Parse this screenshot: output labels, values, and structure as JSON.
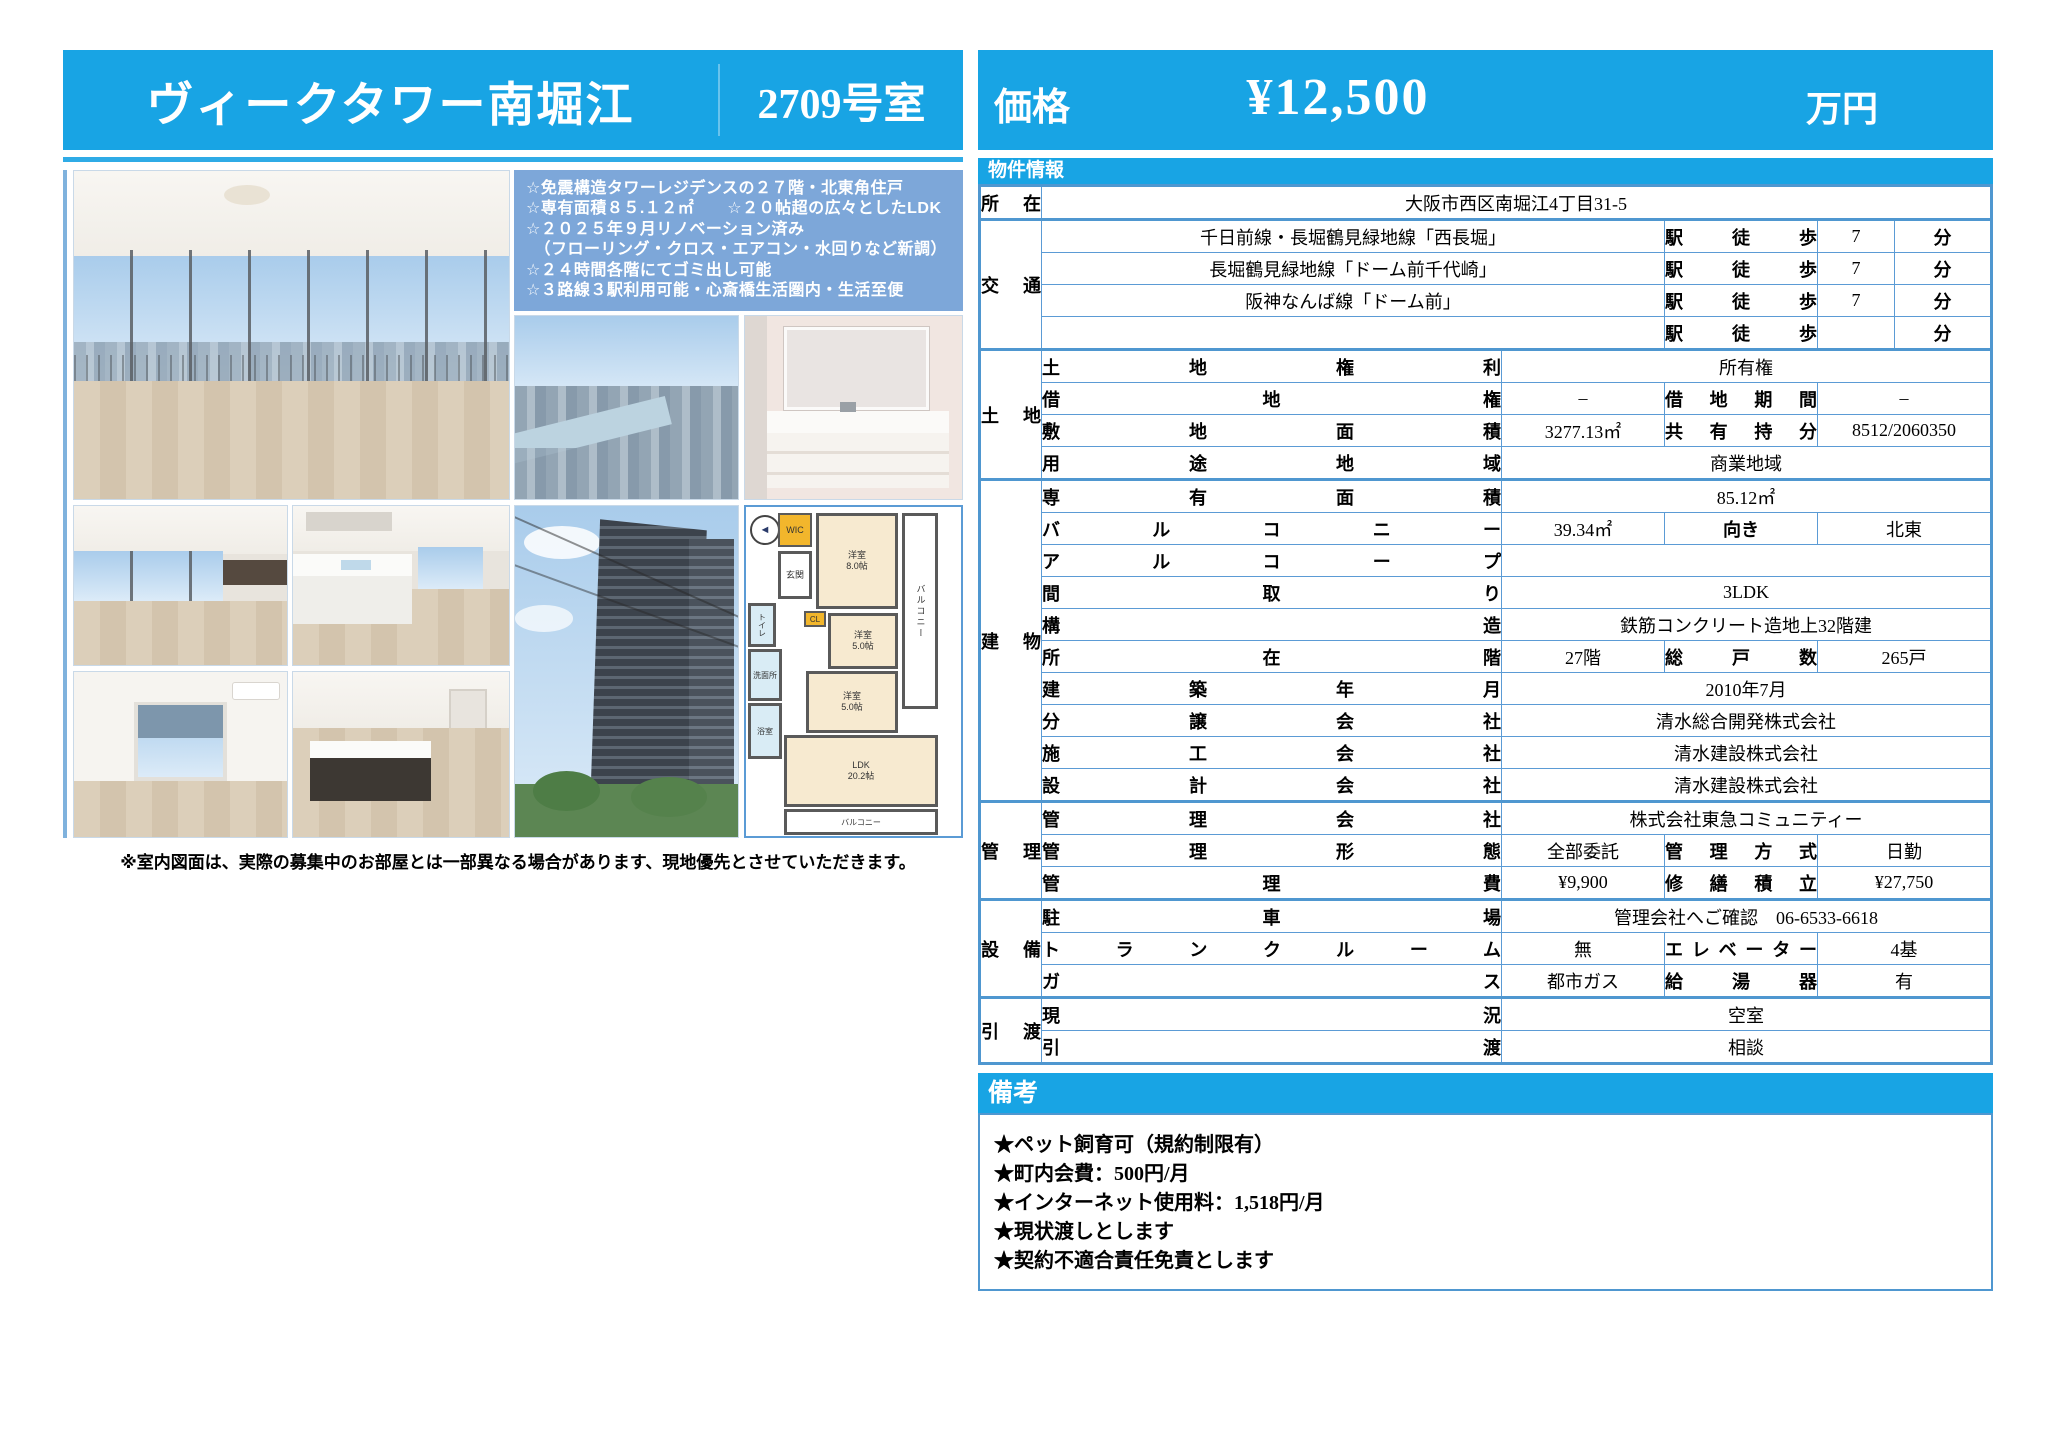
{
  "header": {
    "title": "ヴィークタワー南堀江",
    "room": "2709号室",
    "price_label": "価格",
    "price_value": "¥12,500",
    "price_unit": "万円"
  },
  "features": {
    "lines": [
      "☆免震構造タワーレジデンスの２７階・北東角住戸",
      "☆専有面積８５.１２㎡　　☆２０帖超の広々としたLDK",
      "☆２０２５年９月リノベーション済み",
      "　（フローリング・クロス・エアコン・水回りなど新調）",
      "☆２４時間各階にてゴミ出し可能",
      "☆３路線３駅利用可能・心斎橋生活圏内・生活至便"
    ]
  },
  "floorplan": {
    "wic": "WIC",
    "cl": "CL",
    "genkan": "玄関",
    "toilet": "トイレ",
    "wash": "洗面所",
    "bath": "浴室",
    "room_a": "洋室",
    "room_a_size": "8.0帖",
    "room_b": "洋室",
    "room_b_size": "5.0帖",
    "room_c": "洋室",
    "room_c_size": "5.0帖",
    "ldk": "LDK",
    "ldk_size": "20.2帖",
    "balcony": "バルコニー"
  },
  "disclaimer": "※室内図面は、実際の募集中のお部屋とは一部異なる場合があります、現地優先とさせていただきます。",
  "info": {
    "section_title": "物件情報",
    "shozai": {
      "label": "所 在",
      "value": "大阪市西区南堀江4丁目31-5"
    },
    "kotsu": {
      "label": "交 通",
      "rows": [
        {
          "line": "千日前線・長堀鶴見緑地線「西長堀」",
          "walk": "駅 徒 歩",
          "min": "7",
          "unit": "分"
        },
        {
          "line": "長堀鶴見緑地線「ドーム前千代崎」",
          "walk": "駅 徒 歩",
          "min": "7",
          "unit": "分"
        },
        {
          "line": "阪神なんば線「ドーム前」",
          "walk": "駅 徒 歩",
          "min": "7",
          "unit": "分"
        },
        {
          "line": "",
          "walk": "駅 徒 歩",
          "min": "",
          "unit": "分"
        }
      ]
    },
    "tochi": {
      "label": "土 地",
      "rows": [
        {
          "label": "土 地 権 利",
          "value": "所有権"
        },
        {
          "label": "借 地 権",
          "value": "–",
          "label2": "借 地 期 間",
          "value2": "–"
        },
        {
          "label": "敷 地 面 積",
          "value": "3277.13㎡",
          "label2": "共 有 持 分",
          "value2": "8512/2060350"
        },
        {
          "label": "用 途 地 域",
          "value": "商業地域"
        }
      ]
    },
    "tatemono": {
      "label": "建 物",
      "rows": [
        {
          "label": "専 有 面 積",
          "value": "85.12㎡"
        },
        {
          "label": "バ ル コ ニ ー",
          "value": "39.34㎡",
          "label2": "向き",
          "value2": "北東"
        },
        {
          "label": "ア ル コ ー プ",
          "value": ""
        },
        {
          "label": "間 取 り",
          "value": "3LDK"
        },
        {
          "label": "構 造",
          "value": "鉄筋コンクリート造地上32階建"
        },
        {
          "label": "所 在 階",
          "value": "27階",
          "label2": "総 戸 数",
          "value2": "265戸"
        },
        {
          "label": "建 築 年 月",
          "value": "2010年7月"
        },
        {
          "label": "分 譲 会 社",
          "value": "清水総合開発株式会社"
        },
        {
          "label": "施 工 会 社",
          "value": "清水建設株式会社"
        },
        {
          "label": "設 計 会 社",
          "value": "清水建設株式会社"
        }
      ]
    },
    "kanri": {
      "label": "管 理",
      "rows": [
        {
          "label": "管 理 会 社",
          "value": "株式会社東急コミュニティー"
        },
        {
          "label": "管 理 形 態",
          "value": "全部委託",
          "label2": "管 理 方 式",
          "value2": "日勤"
        },
        {
          "label": "管 理 費",
          "value": "¥9,900",
          "label2": "修 繕 積 立",
          "value2": "¥27,750"
        }
      ]
    },
    "setsubi": {
      "label": "設 備",
      "rows": [
        {
          "label": "駐 車 場",
          "value": "管理会社へご確認　06-6533-6618"
        },
        {
          "label": "トランクルーム",
          "value": "無",
          "label2": "エレベーター",
          "value2": "4基"
        },
        {
          "label": "ガ ス",
          "value": "都市ガス",
          "label2": "給 湯 器",
          "value2": "有"
        }
      ]
    },
    "hikiwatashi": {
      "label": "引 渡",
      "rows": [
        {
          "label": "現 況",
          "value": "空室"
        },
        {
          "label": "引 渡",
          "value": "相談"
        }
      ]
    }
  },
  "remarks": {
    "section_title": "備考",
    "lines": [
      "★ペット飼育可（規約制限有）",
      "★町内会費：500円/月",
      "★インターネット使用料：1,518円/月",
      "★現状渡しとします",
      "★契約不適合責任免責とします"
    ]
  }
}
